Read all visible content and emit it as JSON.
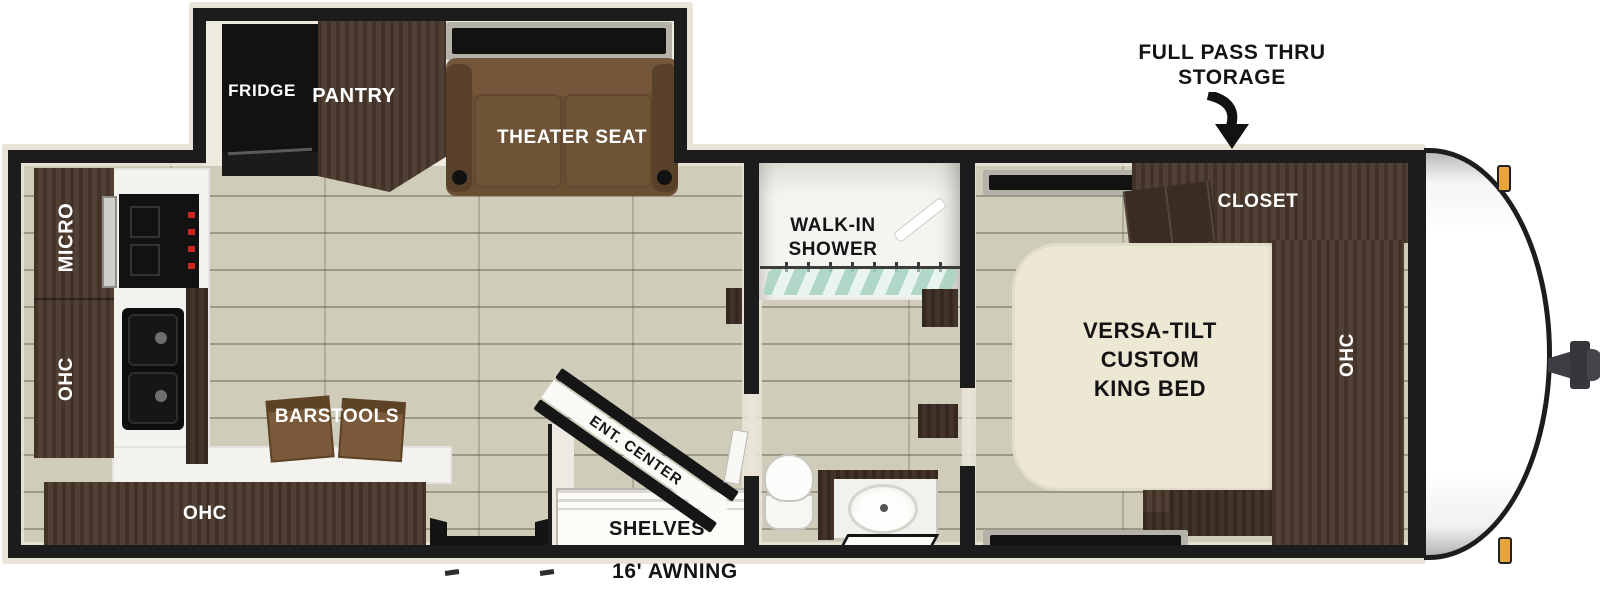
{
  "colors": {
    "wall": "#1c1c1c",
    "trim": "#e9e4d7",
    "floor": "#cfccba",
    "cabinet": "#4a382c",
    "cabinet_dark": "#3a2c22",
    "sofa": "#6b4f33",
    "sofa_dark": "#59402a",
    "bed": "#ece8d4",
    "counter": "#f3f2ee",
    "appliance": "#121212",
    "knob_red": "#c8271f",
    "curtain": "#a9d4c2",
    "marker_light": "#e8a43d",
    "hitch": "#3d3d44"
  },
  "slide_out": {
    "fridge_label": "FRIDGE",
    "pantry_label": "PANTRY",
    "theater_seat_label": "THEATER SEAT"
  },
  "kitchen": {
    "micro_label": "MICRO",
    "ohc_upper_label": "OHC",
    "ohc_lower_label": "OHC",
    "barstools_label": "BARSTOOLS"
  },
  "living": {
    "ent_center_label": "ENT. CENTER",
    "shelves_label": "SHELVES"
  },
  "bathroom": {
    "shower_label_line1": "WALK-IN",
    "shower_label_line2": "SHOWER"
  },
  "bedroom": {
    "closet_label": "CLOSET",
    "ohc_label": "OHC",
    "bed_label_line1": "VERSA-TILT",
    "bed_label_line2": "CUSTOM",
    "bed_label_line3": "KING BED"
  },
  "annotations": {
    "pass_thru_line1": "FULL PASS THRU",
    "pass_thru_line2": "STORAGE",
    "awning_label": "16' AWNING"
  }
}
